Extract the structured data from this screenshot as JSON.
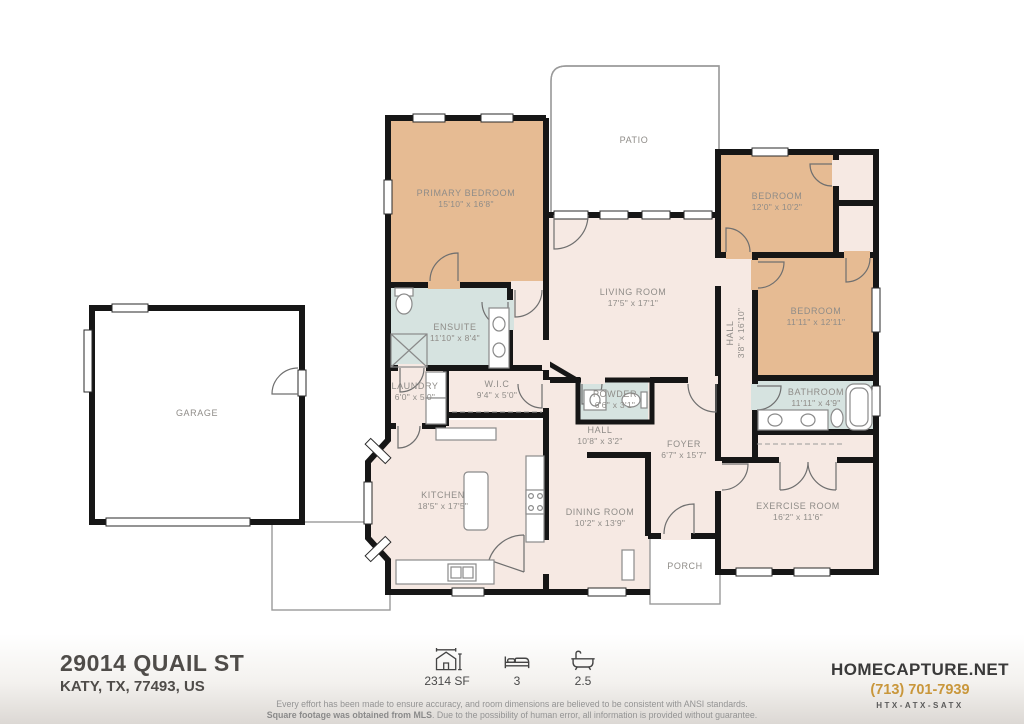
{
  "plan": {
    "rooms": {
      "garage": {
        "name": "GARAGE",
        "dims": ""
      },
      "patio": {
        "name": "PATIO",
        "dims": ""
      },
      "porch": {
        "name": "PORCH",
        "dims": ""
      },
      "primary_bedroom": {
        "name": "PRIMARY BEDROOM",
        "dims": "15'10\" x 16'8\""
      },
      "living_room": {
        "name": "LIVING ROOM",
        "dims": "17'5\" x 17'1\""
      },
      "ensuite": {
        "name": "ENSUITE",
        "dims": "11'10\" x 8'4\""
      },
      "laundry": {
        "name": "LAUNDRY",
        "dims": "6'0\" x 5'0\""
      },
      "wic": {
        "name": "W.I.C",
        "dims": "9'4\" x 5'0\""
      },
      "powder": {
        "name": "POWDER",
        "dims": "6'6\" x 3'1\""
      },
      "hall_center": {
        "name": "HALL",
        "dims": "10'8\" x 3'2\""
      },
      "foyer": {
        "name": "FOYER",
        "dims": "6'7\" x 15'7\""
      },
      "kitchen": {
        "name": "KITCHEN",
        "dims": "18'5\" x 17'5\""
      },
      "dining_room": {
        "name": "DINING ROOM",
        "dims": "10'2\" x 13'9\""
      },
      "bedroom_front": {
        "name": "BEDROOM",
        "dims": "12'0\" x 10'2\""
      },
      "bedroom_middle": {
        "name": "BEDROOM",
        "dims": "11'11\" x 12'11\""
      },
      "hall_right": {
        "name": "HALL",
        "dims": "3'8\" x 16'10\""
      },
      "bathroom": {
        "name": "BATHROOM",
        "dims": "11'11\" x 4'9\""
      },
      "exercise_room": {
        "name": "EXERCISE ROOM",
        "dims": "16'2\" x 11'6\""
      }
    }
  },
  "footer": {
    "address_line1": "29014 QUAIL ST",
    "address_line2": "KATY, TX, 77493, US",
    "stats": [
      {
        "icon": "sqft-icon",
        "value": "2314 SF"
      },
      {
        "icon": "bed-icon",
        "value": "3"
      },
      {
        "icon": "bath-icon",
        "value": "2.5"
      }
    ],
    "brand": "HOMECAPTURE.NET",
    "phone": "(713) 701-7939",
    "regions": "HTX-ATX-SATX",
    "disclaimer_line1": "Every effort has been made to ensure accuracy, and room dimensions are believed to be consistent with ANSI standards.",
    "disclaimer_line2_bold": "Square footage was obtained from MLS",
    "disclaimer_line2_rest": ". Due to the possibility of human error, all information is provided without guarantee."
  },
  "colors": {
    "bedroom_fill": "#e6bb93",
    "floor_fill": "#f6e9e3",
    "bath_fill": "#d6e3e0",
    "wall": "#161616",
    "phone_accent": "#c9973b"
  }
}
